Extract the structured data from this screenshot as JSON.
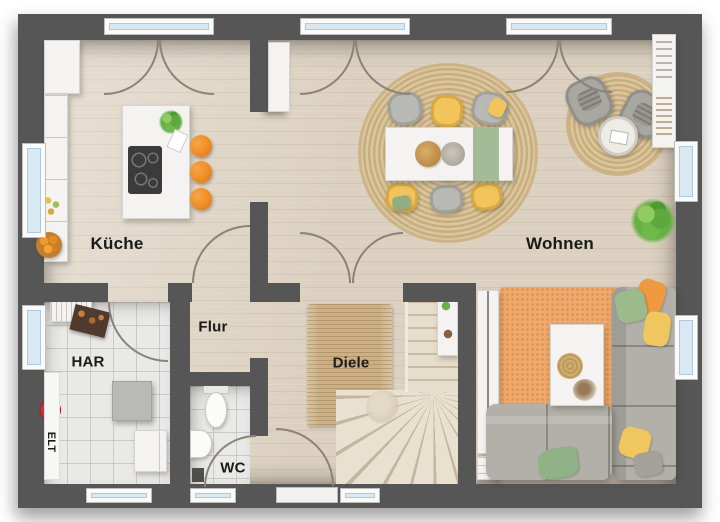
{
  "floorplan": {
    "labels": {
      "kueche": "Küche",
      "wohnen": "Wohnen",
      "flur": "Flur",
      "har": "HAR",
      "diele": "Diele",
      "wc": "WC",
      "elt": "ELT"
    },
    "colors": {
      "wall": "#565656",
      "wood_floor": "#dcd1c1",
      "tile_floor": "#e9e9e7",
      "window_glass": "#d8e9f3",
      "door_arc": "#8d8276",
      "stool_orange": "#ef8a1f",
      "chair_yellow": "#f1c45c",
      "chair_gray": "#b8b9b5",
      "rug_jute": "#d0b88a",
      "rug_orange": "#efa96d",
      "sofa_gray": "#b2b0a9",
      "plant_green": "#67b144",
      "runner_green": "#a3bb97"
    }
  }
}
